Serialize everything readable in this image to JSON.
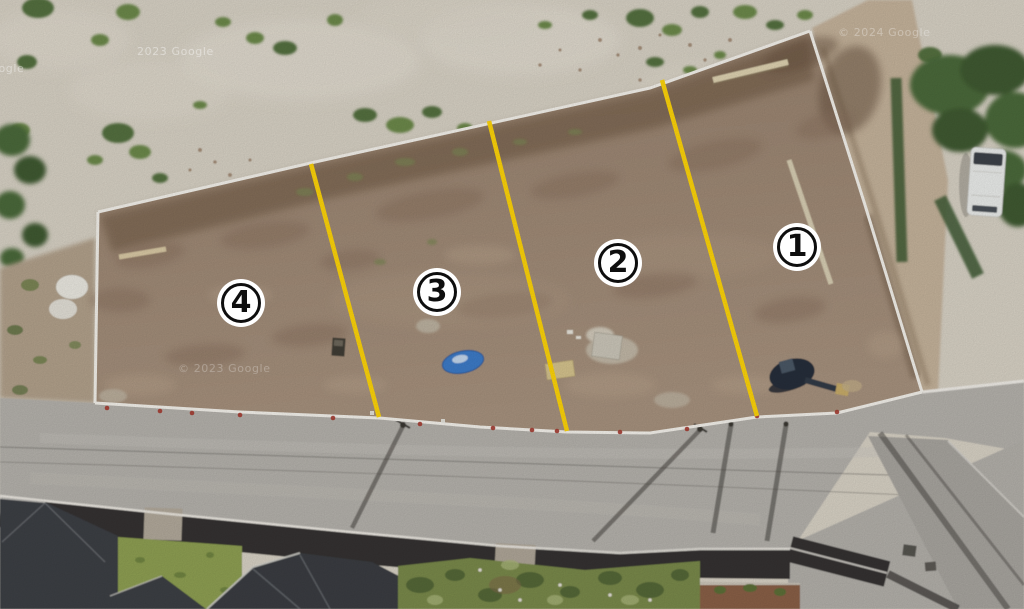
{
  "image_type": "satellite-aerial-photo of vacant land divided into four numbered lots",
  "annotation": {
    "markers": [
      {
        "label": "1"
      },
      {
        "label": "2"
      },
      {
        "label": "3"
      },
      {
        "label": "4"
      }
    ],
    "divider_line_count": 3
  },
  "watermarks": [
    {
      "text": "2023 Google"
    },
    {
      "text": "Google"
    },
    {
      "text": "© 2024 Google"
    },
    {
      "text": "© 2023 Google"
    }
  ],
  "colors": {
    "divider_yellow": "#ffd60a",
    "boundary_white": "#f6f3ed",
    "marker_background": "#ffffff",
    "marker_ring": "#0e0e0e",
    "plot_dirt": "#a18b79",
    "sand": "#d9d3c6",
    "road_gray": "#b6b3ad"
  }
}
